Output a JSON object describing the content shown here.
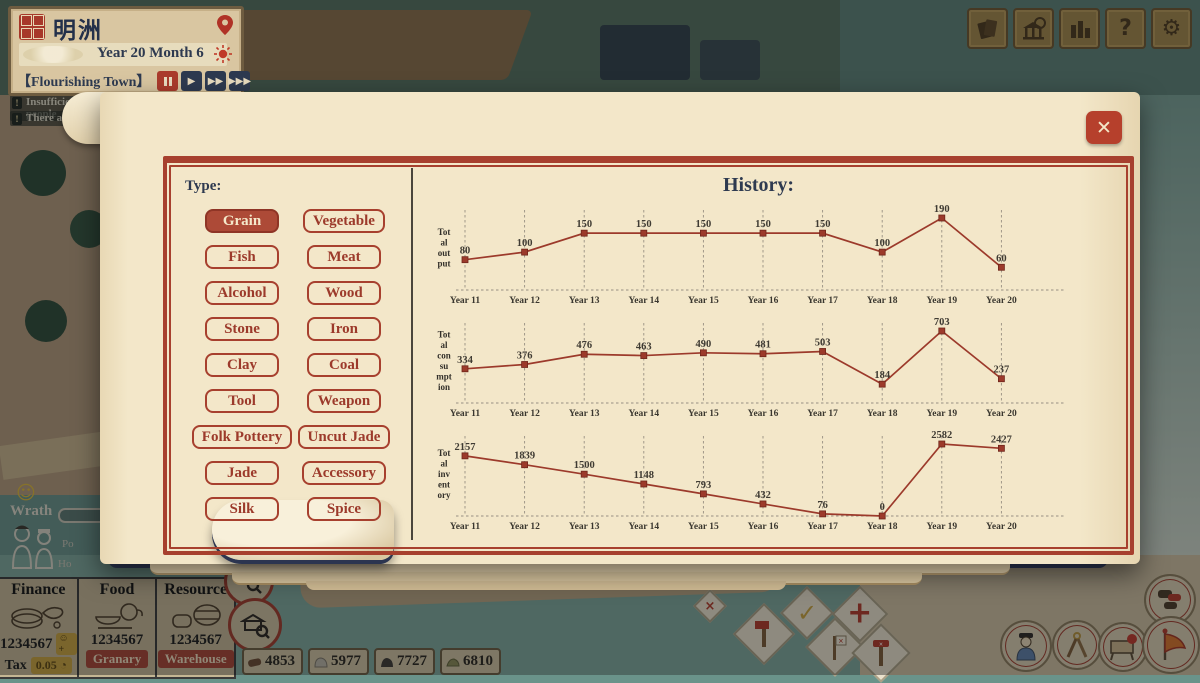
{
  "hud": {
    "town_name": "明洲",
    "date": "Year 20 Month 6",
    "epithet": "【Flourishing Town】"
  },
  "notifications": {
    "line1": "Insufficient housing to accept more people",
    "line2": "There are 5 ru",
    "line3": "about it!"
  },
  "panel": {
    "close_icon": "✕",
    "tabs": [
      {
        "label": "Resources",
        "active": true
      },
      {
        "label": "Finance",
        "active": false
      },
      {
        "label": "People",
        "active": false
      },
      {
        "label": "Building",
        "active": false
      },
      {
        "label": "Takeout",
        "active": false
      },
      {
        "label": "Statistics",
        "active": false
      }
    ],
    "type_label": "Type:",
    "type_buttons": [
      {
        "label": "Grain",
        "active": true
      },
      {
        "label": "Vegetable",
        "active": false
      },
      {
        "label": "Fish",
        "active": false
      },
      {
        "label": "Meat",
        "active": false
      },
      {
        "label": "Alcohol",
        "active": false
      },
      {
        "label": "Wood",
        "active": false
      },
      {
        "label": "Stone",
        "active": false
      },
      {
        "label": "Iron",
        "active": false
      },
      {
        "label": "Clay",
        "active": false
      },
      {
        "label": "Coal",
        "active": false
      },
      {
        "label": "Tool",
        "active": false
      },
      {
        "label": "Weapon",
        "active": false
      },
      {
        "label": "Folk Pottery",
        "active": false
      },
      {
        "label": "Uncut Jade",
        "active": false
      },
      {
        "label": "Jade",
        "active": false
      },
      {
        "label": "Accessory",
        "active": false
      },
      {
        "label": "Silk",
        "active": false
      },
      {
        "label": "Spice",
        "active": false
      }
    ],
    "history": {
      "label": "History:",
      "options": [
        {
          "label": "Year 10",
          "active": true
        },
        {
          "label": "Year 40",
          "active": false
        },
        {
          "label": "Year 160",
          "active": false
        },
        {
          "label": "Year 400",
          "active": false
        }
      ]
    }
  },
  "chart_data": [
    {
      "type": "line",
      "ylabel": "Total output",
      "ylabel_lines": [
        "Tot",
        "al",
        "out",
        "put"
      ],
      "categories": [
        "Year 11",
        "Year 12",
        "Year 13",
        "Year 14",
        "Year 15",
        "Year 16",
        "Year 17",
        "Year 18",
        "Year 19",
        "Year 20"
      ],
      "values": [
        80,
        100,
        150,
        150,
        150,
        150,
        150,
        100,
        190,
        60
      ],
      "ylim": [
        0,
        190
      ],
      "grid": "vertical-dashed",
      "line_color": "#9c3a2b"
    },
    {
      "type": "line",
      "ylabel": "Total consumption",
      "ylabel_lines": [
        "Tot",
        "al",
        "con",
        "su",
        "mpt",
        "ion"
      ],
      "categories": [
        "Year 11",
        "Year 12",
        "Year 13",
        "Year 14",
        "Year 15",
        "Year 16",
        "Year 17",
        "Year 18",
        "Year 19",
        "Year 20"
      ],
      "values": [
        334,
        376,
        476,
        463,
        490,
        481,
        503,
        184,
        703,
        237
      ],
      "ylim": [
        0,
        703
      ],
      "grid": "vertical-dashed",
      "line_color": "#9c3a2b"
    },
    {
      "type": "line",
      "ylabel": "Total inventory",
      "ylabel_lines": [
        "Tot",
        "al",
        "inv",
        "ent",
        "ory"
      ],
      "categories": [
        "Year 11",
        "Year 12",
        "Year 13",
        "Year 14",
        "Year 15",
        "Year 16",
        "Year 17",
        "Year 18",
        "Year 19",
        "Year 20"
      ],
      "values": [
        2157,
        1839,
        1500,
        1148,
        793,
        432,
        76,
        0,
        2582,
        2427
      ],
      "ylim": [
        0,
        2582
      ],
      "grid": "vertical-dashed",
      "line_color": "#9c3a2b"
    }
  ],
  "status": {
    "happiness": "88",
    "smiley_icon": "☺",
    "heart_icon": "♥",
    "wrath_label": "Wrath",
    "row_label_1": "Po",
    "row_label_2": "Ho"
  },
  "bottom_panel": {
    "columns": [
      {
        "title": "Finance",
        "value": "1234567",
        "badge": "☺+",
        "tax_label": "Tax",
        "tax_value": "0.05"
      },
      {
        "title": "Food",
        "value": "1234567",
        "button": "Granary"
      },
      {
        "title": "Resource",
        "value": "1234567",
        "button": "Warehouse"
      }
    ]
  },
  "resource_pills": [
    {
      "name": "wood",
      "value": "4853"
    },
    {
      "name": "stone",
      "value": "5977"
    },
    {
      "name": "coal",
      "value": "7727"
    },
    {
      "name": "clay",
      "value": "6810"
    }
  ],
  "colors": {
    "accent_red": "#a7402e",
    "navy": "#2e3a50",
    "gold": "#b7933d",
    "chart_line": "#9c3a2b",
    "page": "#f3e7c9"
  }
}
